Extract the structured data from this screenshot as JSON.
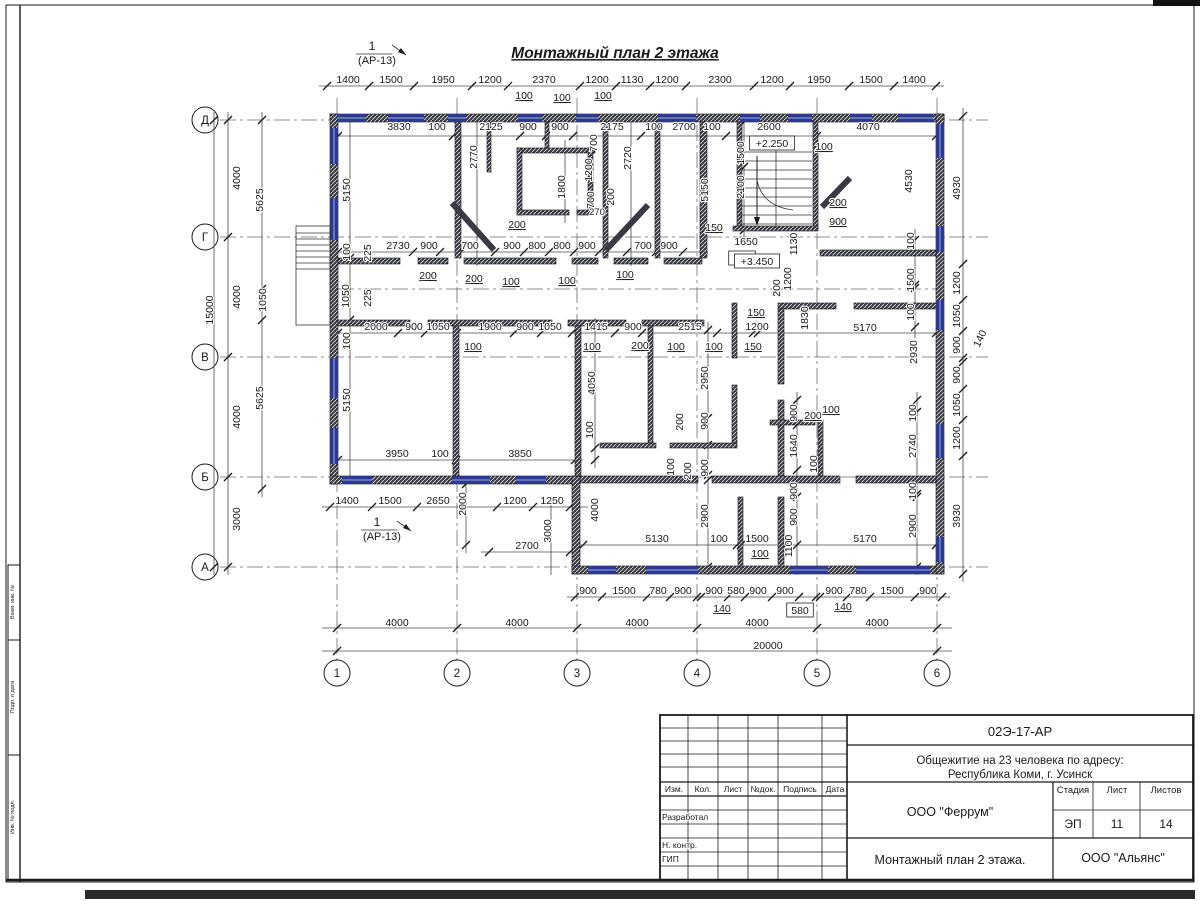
{
  "sheet": {
    "drawing_title": "Монтажный план 2 этажа",
    "section_marker_num": "1",
    "section_marker_ref": "(АР-13)",
    "levels": {
      "stair_mid": "+2.250",
      "floor": "+3.450"
    }
  },
  "axes": {
    "rows": [
      "Д",
      "Г",
      "В",
      "Б",
      "А"
    ],
    "cols": [
      "1",
      "2",
      "3",
      "4",
      "5",
      "6"
    ]
  },
  "title_block": {
    "doc_number": "02Э-17-АР",
    "project_line1": "Общежитие на 23 человека по адресу:",
    "project_line2": "Республика Коми, г. Усинск",
    "designer_org": "ООО \"Феррум\"",
    "sheet_title": "Монтажный план 2 этажа.",
    "contractor_org": "ООО \"Альянс\"",
    "stage_label": "Стадия",
    "sheet_label": "Лист",
    "sheets_label": "Листов",
    "stage": "ЭП",
    "sheet": "11",
    "sheets": "14",
    "col_izm": "Изм.",
    "col_kol": "Кол.",
    "col_list": "Лист",
    "col_doc": "№док.",
    "col_sign": "Подпись",
    "col_date": "Дата",
    "row_developed": "Разработал",
    "row_ncontr": "Н. контр.",
    "row_gip": "ГИП"
  },
  "stamp_column": {
    "box1": "Взам. инв. №",
    "box2": "Подп. и дата",
    "box3": "Инв. № подл."
  },
  "dim_labels": [
    {
      "t": "1400",
      "x": 348,
      "y": 83
    },
    {
      "t": "1500",
      "x": 391,
      "y": 83
    },
    {
      "t": "1950",
      "x": 443,
      "y": 83
    },
    {
      "t": "1200",
      "x": 490,
      "y": 83
    },
    {
      "t": "2370",
      "x": 544,
      "y": 83
    },
    {
      "t": "1200",
      "x": 597,
      "y": 83
    },
    {
      "t": "1130",
      "x": 632,
      "y": 83
    },
    {
      "t": "1200",
      "x": 667,
      "y": 83
    },
    {
      "t": "2300",
      "x": 720,
      "y": 83
    },
    {
      "t": "1200",
      "x": 772,
      "y": 83
    },
    {
      "t": "1950",
      "x": 819,
      "y": 83
    },
    {
      "t": "1500",
      "x": 871,
      "y": 83
    },
    {
      "t": "1400",
      "x": 914,
      "y": 83
    },
    {
      "t": "100",
      "x": 524,
      "y": 99,
      "u": 1
    },
    {
      "t": "100",
      "x": 562,
      "y": 101,
      "u": 1
    },
    {
      "t": "100",
      "x": 603,
      "y": 99,
      "u": 1
    },
    {
      "t": "3830",
      "x": 399,
      "y": 130
    },
    {
      "t": "100",
      "x": 437,
      "y": 130
    },
    {
      "t": "2125",
      "x": 491,
      "y": 130
    },
    {
      "t": "900",
      "x": 528,
      "y": 130
    },
    {
      "t": "900",
      "x": 560,
      "y": 130
    },
    {
      "t": "2175",
      "x": 612,
      "y": 130
    },
    {
      "t": "100",
      "x": 654,
      "y": 130
    },
    {
      "t": "2700",
      "x": 684,
      "y": 130
    },
    {
      "t": "100",
      "x": 712,
      "y": 130
    },
    {
      "t": "2600",
      "x": 769,
      "y": 130
    },
    {
      "t": "4070",
      "x": 868,
      "y": 130
    },
    {
      "t": "4000",
      "x": 240,
      "y": 178,
      "r": -90
    },
    {
      "t": "5625",
      "x": 263,
      "y": 200,
      "r": -90
    },
    {
      "t": "15000",
      "x": 213,
      "y": 310,
      "r": -90
    },
    {
      "t": "4000",
      "x": 240,
      "y": 297,
      "r": -90
    },
    {
      "t": "1050",
      "x": 266,
      "y": 300,
      "r": -90
    },
    {
      "t": "5625",
      "x": 263,
      "y": 398,
      "r": -90
    },
    {
      "t": "4000",
      "x": 240,
      "y": 417,
      "r": -90
    },
    {
      "t": "3000",
      "x": 240,
      "y": 519,
      "r": -90
    },
    {
      "t": "4930",
      "x": 960,
      "y": 188,
      "r": -90
    },
    {
      "t": "1200",
      "x": 960,
      "y": 283,
      "r": -90
    },
    {
      "t": "1050",
      "x": 960,
      "y": 316,
      "r": -90
    },
    {
      "t": "900",
      "x": 960,
      "y": 345,
      "r": -90
    },
    {
      "t": "140",
      "x": 983,
      "y": 340,
      "r": -65
    },
    {
      "t": "900",
      "x": 960,
      "y": 375,
      "r": -90
    },
    {
      "t": "1050",
      "x": 960,
      "y": 405,
      "r": -90
    },
    {
      "t": "1200",
      "x": 960,
      "y": 438,
      "r": -90
    },
    {
      "t": "3930",
      "x": 960,
      "y": 516,
      "r": -90
    },
    {
      "t": "900",
      "x": 588,
      "y": 594
    },
    {
      "t": "1500",
      "x": 624,
      "y": 594
    },
    {
      "t": "780",
      "x": 658,
      "y": 594
    },
    {
      "t": "900",
      "x": 683,
      "y": 594
    },
    {
      "t": "900",
      "x": 714,
      "y": 594
    },
    {
      "t": "580",
      "x": 736,
      "y": 594
    },
    {
      "t": "900",
      "x": 758,
      "y": 594
    },
    {
      "t": "900",
      "x": 785,
      "y": 594
    },
    {
      "t": "900",
      "x": 834,
      "y": 594
    },
    {
      "t": "780",
      "x": 858,
      "y": 594
    },
    {
      "t": "1500",
      "x": 892,
      "y": 594
    },
    {
      "t": "900",
      "x": 928,
      "y": 594
    },
    {
      "t": "140",
      "x": 722,
      "y": 612,
      "u": 1
    },
    {
      "t": "580",
      "x": 800,
      "y": 614,
      "b": 1
    },
    {
      "t": "140",
      "x": 843,
      "y": 610,
      "u": 1
    },
    {
      "t": "4000",
      "x": 397,
      "y": 626
    },
    {
      "t": "4000",
      "x": 517,
      "y": 626
    },
    {
      "t": "4000",
      "x": 637,
      "y": 626
    },
    {
      "t": "4000",
      "x": 757,
      "y": 626
    },
    {
      "t": "4000",
      "x": 877,
      "y": 626
    },
    {
      "t": "20000",
      "x": 768,
      "y": 649
    },
    {
      "t": "5150",
      "x": 350,
      "y": 190,
      "r": -90
    },
    {
      "t": "2770",
      "x": 477,
      "y": 157,
      "r": -90
    },
    {
      "t": "1800",
      "x": 565,
      "y": 187,
      "r": -90
    },
    {
      "t": "700",
      "x": 597,
      "y": 143,
      "r": -90
    },
    {
      "t": "1200",
      "x": 592,
      "y": 170,
      "r": -90
    },
    {
      "t": "700",
      "x": 594,
      "y": 200,
      "r": -90
    },
    {
      "t": "200",
      "x": 614,
      "y": 197,
      "r": -90
    },
    {
      "t": "270",
      "x": 597,
      "y": 215,
      "s": 9.5
    },
    {
      "t": "2720",
      "x": 631,
      "y": 158,
      "r": -90
    },
    {
      "t": "5150",
      "x": 708,
      "y": 190,
      "r": -90
    },
    {
      "t": "1500",
      "x": 744,
      "y": 153,
      "r": -90
    },
    {
      "t": "2100",
      "x": 744,
      "y": 187,
      "r": -90
    },
    {
      "t": "100",
      "x": 824,
      "y": 150,
      "u": 1
    },
    {
      "t": "4530",
      "x": 912,
      "y": 181,
      "r": -90
    },
    {
      "t": "200",
      "x": 838,
      "y": 206,
      "u": 1
    },
    {
      "t": "900",
      "x": 838,
      "y": 225,
      "u": 1
    },
    {
      "t": "1650",
      "x": 746,
      "y": 245
    },
    {
      "t": "150",
      "x": 714,
      "y": 231,
      "u": 1
    },
    {
      "t": "100",
      "x": 742,
      "y": 262,
      "b": 1
    },
    {
      "t": "+2.250",
      "x": 772,
      "y": 147,
      "b": 1
    },
    {
      "t": "+3.450",
      "x": 757,
      "y": 265,
      "b": 1
    },
    {
      "t": "100",
      "x": 350,
      "y": 252,
      "r": -90
    },
    {
      "t": "225",
      "x": 371,
      "y": 253,
      "r": -90
    },
    {
      "t": "2730",
      "x": 398,
      "y": 249
    },
    {
      "t": "900",
      "x": 429,
      "y": 249
    },
    {
      "t": "700",
      "x": 470,
      "y": 249
    },
    {
      "t": "900",
      "x": 512,
      "y": 249
    },
    {
      "t": "800",
      "x": 537,
      "y": 249
    },
    {
      "t": "800",
      "x": 562,
      "y": 249
    },
    {
      "t": "900",
      "x": 587,
      "y": 249
    },
    {
      "t": "700",
      "x": 643,
      "y": 249
    },
    {
      "t": "900",
      "x": 669,
      "y": 249
    },
    {
      "t": "200",
      "x": 428,
      "y": 279,
      "u": 1
    },
    {
      "t": "200",
      "x": 474,
      "y": 282,
      "u": 1
    },
    {
      "t": "200",
      "x": 517,
      "y": 228,
      "u": 1
    },
    {
      "t": "100",
      "x": 511,
      "y": 285,
      "u": 1
    },
    {
      "t": "100",
      "x": 567,
      "y": 284,
      "u": 1
    },
    {
      "t": "100",
      "x": 625,
      "y": 278,
      "u": 1
    },
    {
      "t": "1050",
      "x": 349,
      "y": 296,
      "r": -90
    },
    {
      "t": "225",
      "x": 371,
      "y": 298,
      "r": -90
    },
    {
      "t": "100",
      "x": 350,
      "y": 341,
      "r": -90
    },
    {
      "t": "2000",
      "x": 376,
      "y": 330
    },
    {
      "t": "900",
      "x": 414,
      "y": 330
    },
    {
      "t": "1050",
      "x": 438,
      "y": 330
    },
    {
      "t": "1900",
      "x": 490,
      "y": 330
    },
    {
      "t": "900",
      "x": 525,
      "y": 330
    },
    {
      "t": "1050",
      "x": 550,
      "y": 330
    },
    {
      "t": "1415",
      "x": 596,
      "y": 330
    },
    {
      "t": "900",
      "x": 633,
      "y": 330
    },
    {
      "t": "2515",
      "x": 690,
      "y": 330
    },
    {
      "t": "1200",
      "x": 757,
      "y": 330
    },
    {
      "t": "150",
      "x": 756,
      "y": 316,
      "u": 1
    },
    {
      "t": "150",
      "x": 753,
      "y": 350,
      "u": 1
    },
    {
      "t": "100",
      "x": 473,
      "y": 350,
      "u": 1
    },
    {
      "t": "100",
      "x": 592,
      "y": 350,
      "u": 1
    },
    {
      "t": "200",
      "x": 640,
      "y": 349,
      "u": 1
    },
    {
      "t": "100",
      "x": 676,
      "y": 350,
      "u": 1
    },
    {
      "t": "100",
      "x": 714,
      "y": 350,
      "u": 1
    },
    {
      "t": "1830",
      "x": 808,
      "y": 318,
      "r": -90
    },
    {
      "t": "5170",
      "x": 865,
      "y": 331
    },
    {
      "t": "2930",
      "x": 917,
      "y": 352,
      "r": -90
    },
    {
      "t": "100",
      "x": 914,
      "y": 241,
      "r": -90
    },
    {
      "t": "1500",
      "x": 914,
      "y": 280,
      "r": -90
    },
    {
      "t": "100",
      "x": 914,
      "y": 312,
      "r": -90
    },
    {
      "t": "1130",
      "x": 797,
      "y": 244,
      "r": -90
    },
    {
      "t": "1200",
      "x": 791,
      "y": 279,
      "r": -90
    },
    {
      "t": "200",
      "x": 780,
      "y": 288,
      "r": -90
    },
    {
      "t": "5150",
      "x": 350,
      "y": 400,
      "r": -90
    },
    {
      "t": "3950",
      "x": 397,
      "y": 457
    },
    {
      "t": "100",
      "x": 440,
      "y": 457
    },
    {
      "t": "3850",
      "x": 520,
      "y": 457
    },
    {
      "t": "4050",
      "x": 595,
      "y": 383,
      "r": -90
    },
    {
      "t": "100",
      "x": 593,
      "y": 430,
      "r": -90
    },
    {
      "t": "1400",
      "x": 347,
      "y": 504
    },
    {
      "t": "1500",
      "x": 390,
      "y": 504
    },
    {
      "t": "2650",
      "x": 438,
      "y": 504
    },
    {
      "t": "2000",
      "x": 466,
      "y": 504,
      "r": -90
    },
    {
      "t": "1200",
      "x": 515,
      "y": 504
    },
    {
      "t": "1250",
      "x": 552,
      "y": 504
    },
    {
      "t": "3000",
      "x": 551,
      "y": 531,
      "r": -90
    },
    {
      "t": "2700",
      "x": 527,
      "y": 549
    },
    {
      "t": "4000",
      "x": 598,
      "y": 510,
      "r": -90
    },
    {
      "t": "2950",
      "x": 708,
      "y": 378,
      "r": -90
    },
    {
      "t": "900",
      "x": 708,
      "y": 421,
      "r": -90
    },
    {
      "t": "200",
      "x": 683,
      "y": 422,
      "r": -90
    },
    {
      "t": "100",
      "x": 674,
      "y": 467,
      "r": -90
    },
    {
      "t": "200",
      "x": 691,
      "y": 471,
      "r": -90
    },
    {
      "t": "900",
      "x": 708,
      "y": 468,
      "r": -90
    },
    {
      "t": "2900",
      "x": 708,
      "y": 516,
      "r": -90
    },
    {
      "t": "5130",
      "x": 657,
      "y": 542
    },
    {
      "t": "100",
      "x": 719,
      "y": 542
    },
    {
      "t": "1500",
      "x": 757,
      "y": 542
    },
    {
      "t": "100",
      "x": 760,
      "y": 557,
      "u": 1
    },
    {
      "t": "1100",
      "x": 792,
      "y": 546,
      "r": -90
    },
    {
      "t": "900",
      "x": 797,
      "y": 413,
      "r": -90
    },
    {
      "t": "200",
      "x": 813,
      "y": 419,
      "u": 1
    },
    {
      "t": "100",
      "x": 831,
      "y": 413,
      "u": 1
    },
    {
      "t": "1640",
      "x": 797,
      "y": 446,
      "r": -90
    },
    {
      "t": "100",
      "x": 817,
      "y": 464,
      "r": -90
    },
    {
      "t": "900",
      "x": 797,
      "y": 491,
      "r": -90
    },
    {
      "t": "900",
      "x": 797,
      "y": 517,
      "r": -90
    },
    {
      "t": "5170",
      "x": 865,
      "y": 542
    },
    {
      "t": "100",
      "x": 916,
      "y": 413,
      "r": -90
    },
    {
      "t": "2740",
      "x": 916,
      "y": 446,
      "r": -90
    },
    {
      "t": "100",
      "x": 916,
      "y": 491,
      "r": -90
    },
    {
      "t": "2900",
      "x": 916,
      "y": 526,
      "r": -90
    }
  ]
}
